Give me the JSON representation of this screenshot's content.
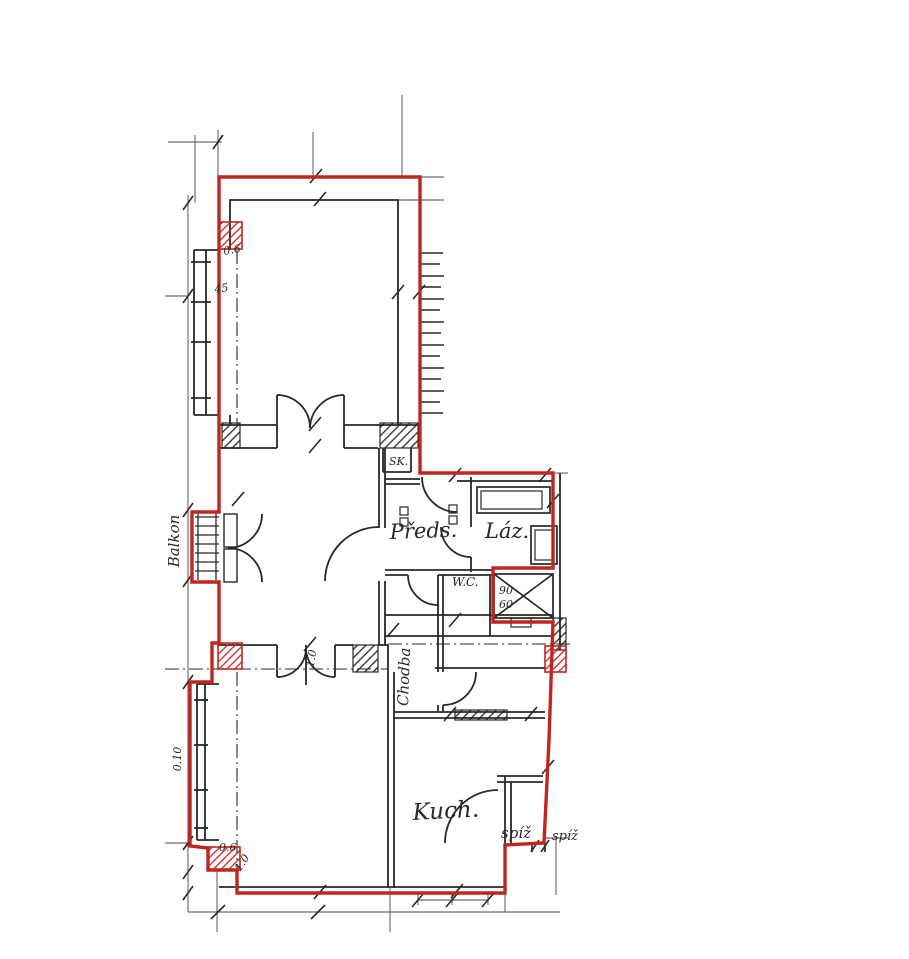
{
  "plan": {
    "rooms": {
      "balkon": "Balkon",
      "sk": "SK.",
      "predsin": "Předs.",
      "lazen": "Láz.",
      "wc": "W.C.",
      "chodba": "Chodba",
      "kuchyn": "Kuch.",
      "spiz": "spíž",
      "spiz_neighbor": "spíž"
    },
    "dimensions": {
      "top_left_depth": "0.6",
      "top_left_width": "45",
      "bay_depth": "0.10",
      "bottom_left_a": "0.6",
      "bottom_left_b": "1.0",
      "door_width": "1.0",
      "shaft_w": "90",
      "shaft_h": "60"
    },
    "colors": {
      "boundary": "#c2251f",
      "ink": "#2b2722",
      "paper": "#ffffff"
    }
  }
}
